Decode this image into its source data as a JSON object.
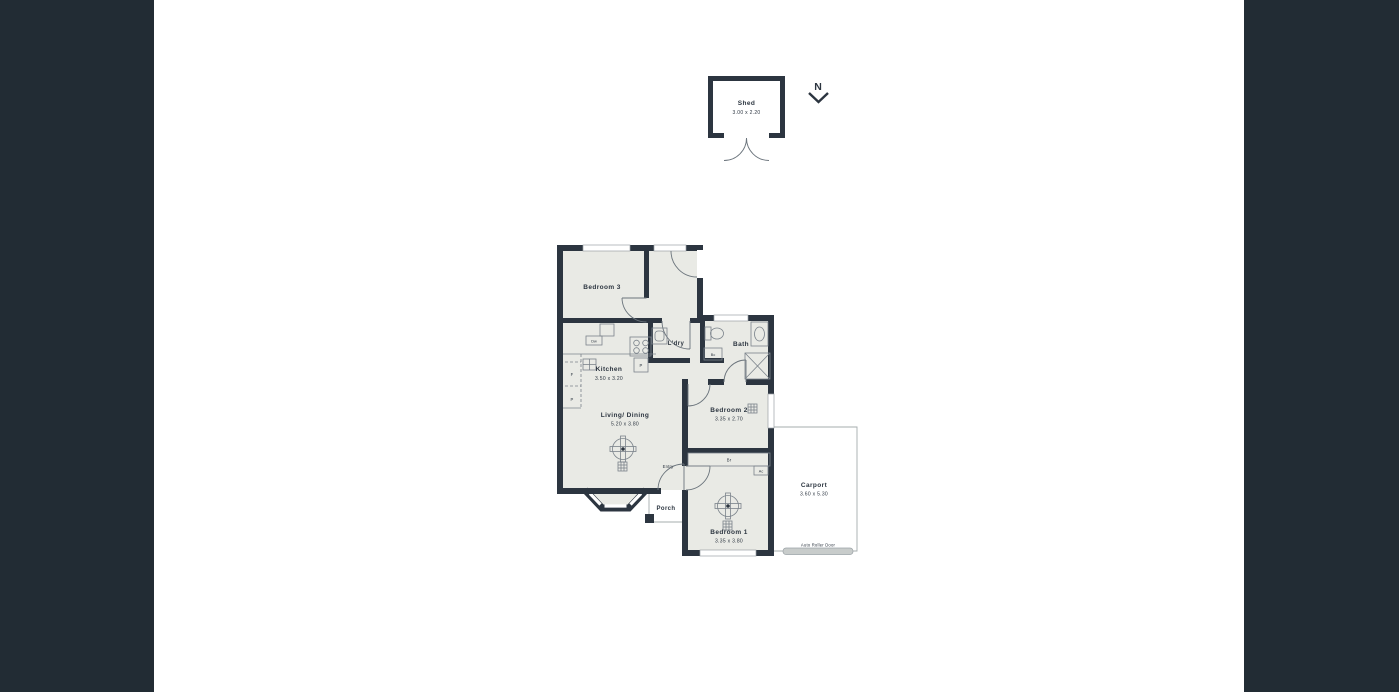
{
  "palette": {
    "side_panel": "#222C34",
    "wall": "#2C3540",
    "floor": "#E9EAE5",
    "outline": "#9BA2A6",
    "roller_door_fill": "#C8CCCB"
  },
  "compass": {
    "label": "N"
  },
  "shed": {
    "label": "Shed",
    "dims": "3.00 x 2.20"
  },
  "rooms": {
    "bedroom3": {
      "label": "Bedroom 3"
    },
    "kitchen": {
      "label": "Kitchen",
      "dims": "3.50 x 3.20"
    },
    "laundry": {
      "label": "L'dry"
    },
    "bath": {
      "label": "Bath"
    },
    "living": {
      "label": "Living/ Dining",
      "dims": "5.20 x 3.80"
    },
    "bedroom2": {
      "label": "Bedroom 2",
      "dims": "3.35 x 2.70"
    },
    "bedroom1": {
      "label": "Bedroom 1",
      "dims": "3.35 x 3.80"
    },
    "porch": {
      "label": "Porch"
    },
    "entry": {
      "label": "Entry"
    },
    "carport": {
      "label": "Carport",
      "dims": "3.60 x 5.30"
    }
  },
  "markers": {
    "fridge": "F",
    "pantry": "P",
    "dishwasher": "Dw",
    "broom_cupboard": "Bc",
    "built_in_robe": "Br",
    "air_conditioner": "Ac",
    "auto_roller_door": "Auto Roller Door"
  },
  "icons": {
    "north_arrow": "chevron-down under letter N",
    "ceiling_fan": "circle with 4-blade cross",
    "light_vent": "3x3 grid square",
    "shower": "square with X",
    "stove": "4-burner cooktop",
    "double_doors": "two quarter-arc leaves"
  }
}
